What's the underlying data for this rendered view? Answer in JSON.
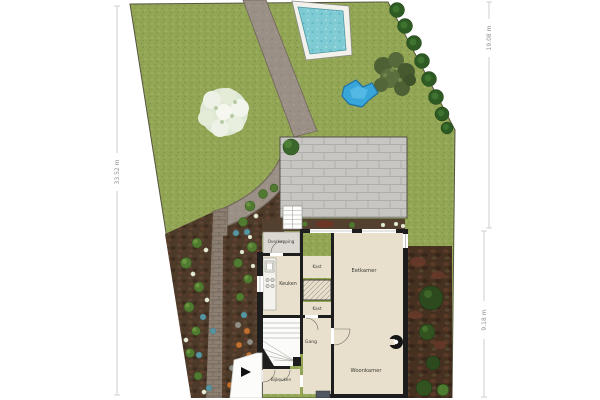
{
  "plan": {
    "type": "garden-site-plan-with-floor-plan",
    "rooms": {
      "overkapping": "Overkapping",
      "keuken": "Keuken",
      "kast_top": "Kast",
      "kast_bottom": "Kast",
      "eetkamer": "Eetkamer",
      "gang": "Gang",
      "bijkeuken": "Bijkeuken",
      "woonkamer": "Woonkamer"
    },
    "dimensions": {
      "left_side": "33.52 m",
      "right_top": "19.08 m",
      "right_bottom": "9.18 m"
    },
    "colors": {
      "grass": "#92a655",
      "path_gray": "#9b9085",
      "brick_path": "#8c7f72",
      "soil_bed": "#4e3a29",
      "pool_water": "#7fcbd3",
      "pond_water": "#38a6d9",
      "terrace_tiles": "#c7c6c2",
      "floor_beige": "#e8e0cc",
      "wall_black": "#1d1d1d",
      "tree_green": "#2e5a23"
    }
  }
}
